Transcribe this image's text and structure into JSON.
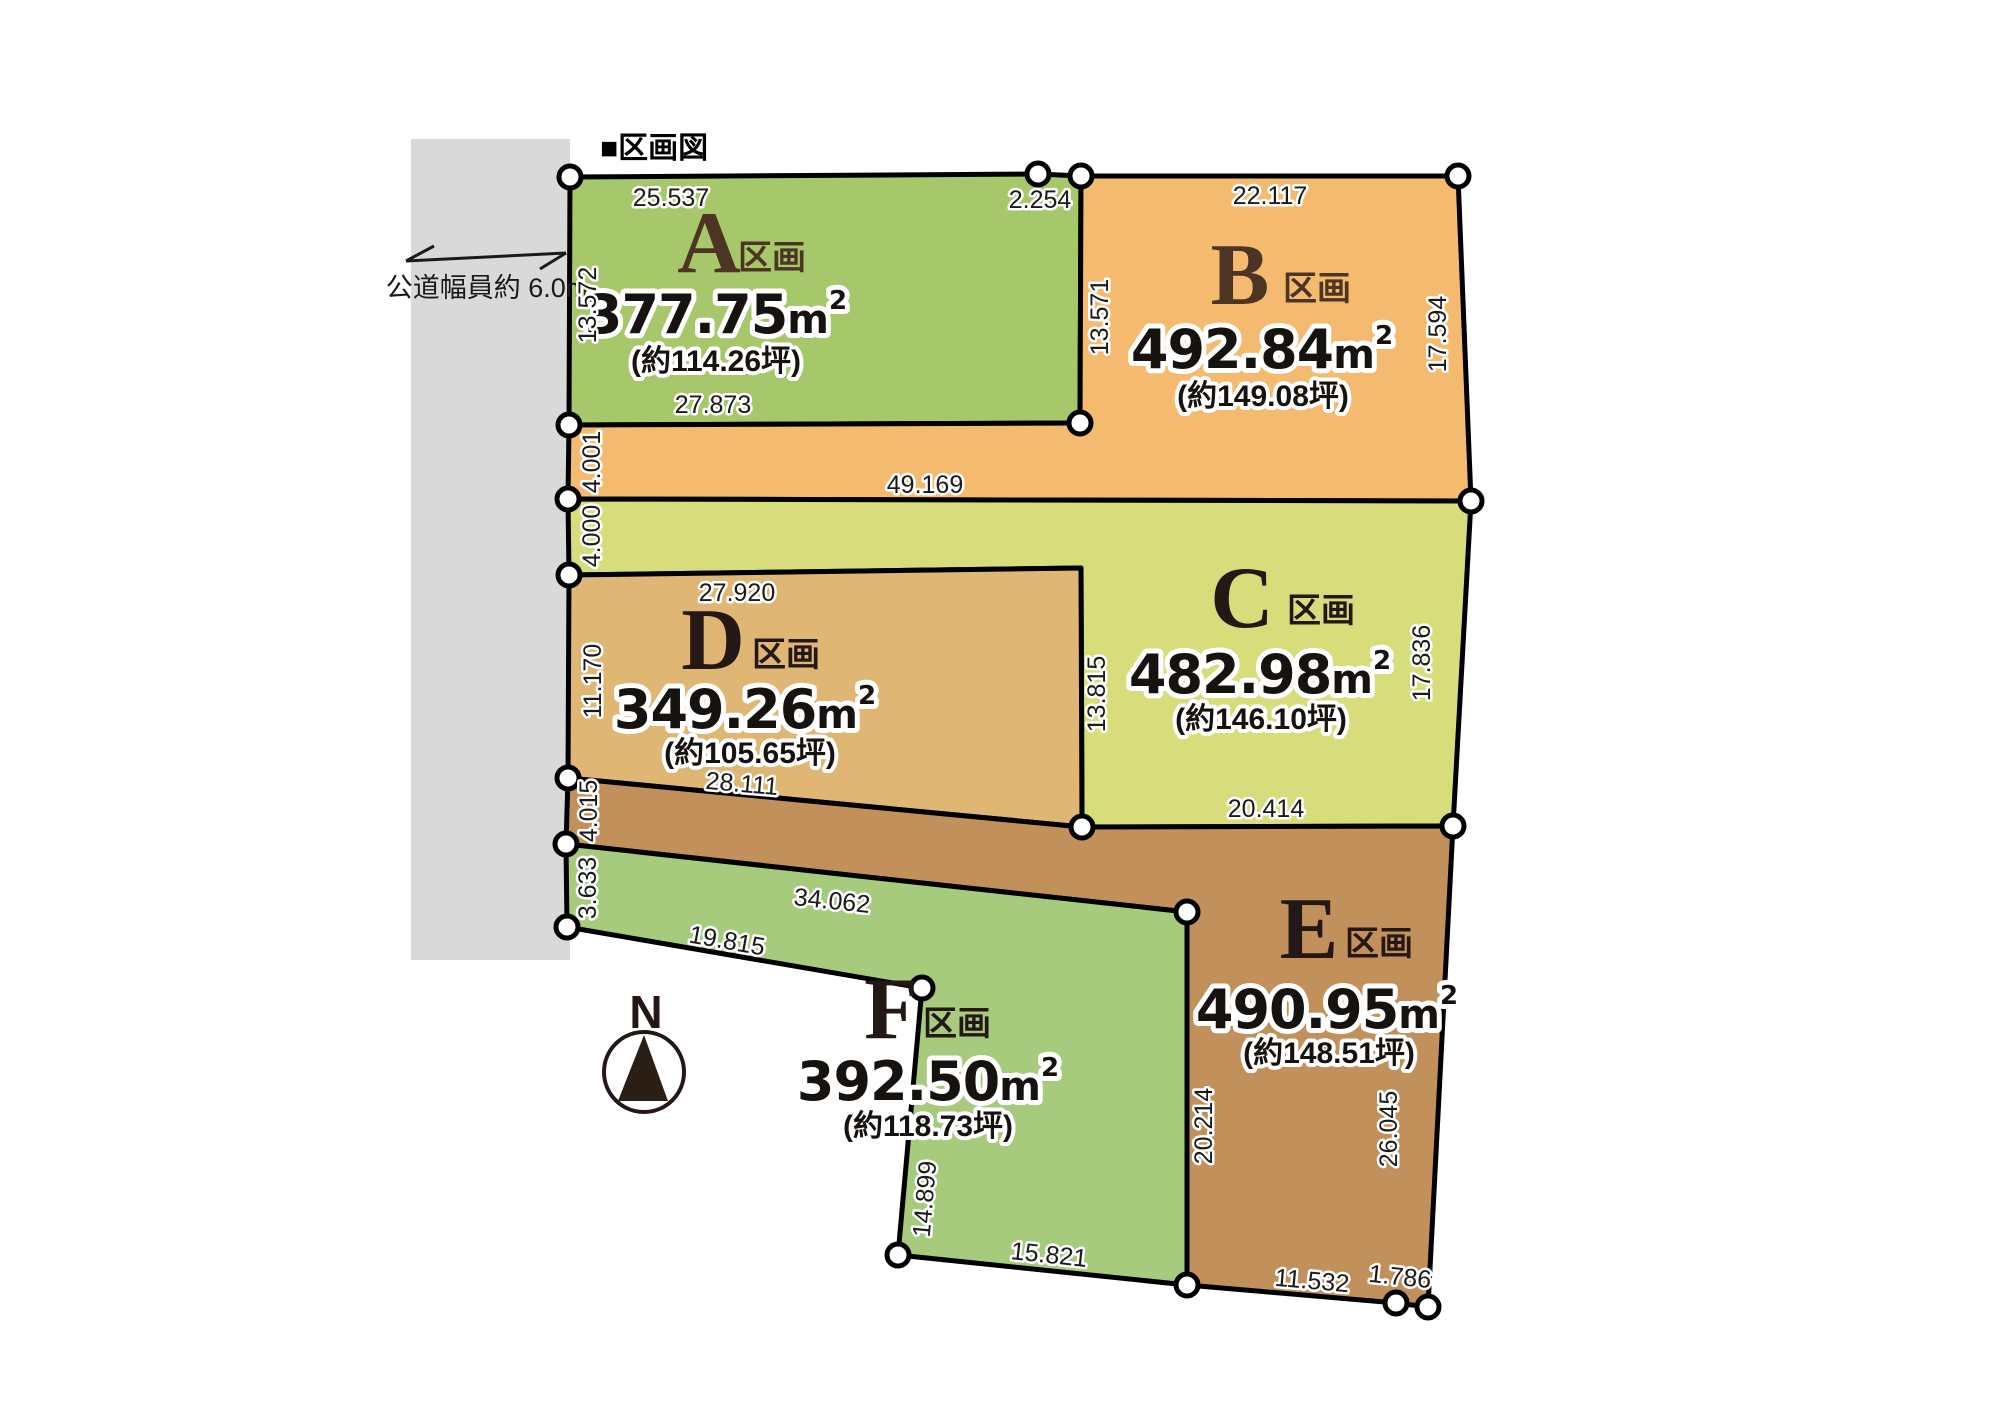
{
  "title": "■区画図",
  "road": {
    "label": "公道幅員約 6.0m",
    "color": "#d9d9d9"
  },
  "compass": {
    "label": "N"
  },
  "plots": [
    {
      "letter": "A",
      "suffix": "区画",
      "area": "377.75",
      "unit": "m",
      "exp": "2",
      "tsubo": "(約114.26坪)",
      "color": "#a6c86b",
      "letter_color": "#4d3524"
    },
    {
      "letter": "B",
      "suffix": "区画",
      "area": "492.84",
      "unit": "m",
      "exp": "2",
      "tsubo": "(約149.08坪)",
      "color": "#f4bb70",
      "letter_color": "#4d3524"
    },
    {
      "letter": "C",
      "suffix": "区画",
      "area": "482.98",
      "unit": "m",
      "exp": "2",
      "tsubo": "(約146.10坪)",
      "color": "#d6dd7a",
      "letter_color": "#231815"
    },
    {
      "letter": "D",
      "suffix": "区画",
      "area": "349.26",
      "unit": "m",
      "exp": "2",
      "tsubo": "(約105.65坪)",
      "color": "#dfb673",
      "letter_color": "#231815"
    },
    {
      "letter": "E",
      "suffix": "区画",
      "area": "490.95",
      "unit": "m",
      "exp": "2",
      "tsubo": "(約148.51坪)",
      "color": "#c2905a",
      "letter_color": "#231815"
    },
    {
      "letter": "F",
      "suffix": "区画",
      "area": "392.50",
      "unit": "m",
      "exp": "2",
      "tsubo": "(約118.73坪)",
      "color": "#a7cb7d",
      "letter_color": "#231815"
    }
  ],
  "dimensions": [
    "25.537",
    "2.254",
    "22.117",
    "13.572",
    "13.571",
    "17.594",
    "27.873",
    "4.001",
    "49.169",
    "4.000",
    "27.920",
    "13.815",
    "17.836",
    "11.170",
    "28.111",
    "20.414",
    "4.015",
    "3.633",
    "34.062",
    "19.815",
    "14.899",
    "15.821",
    "20.214",
    "26.045",
    "11.532",
    "1.786"
  ]
}
